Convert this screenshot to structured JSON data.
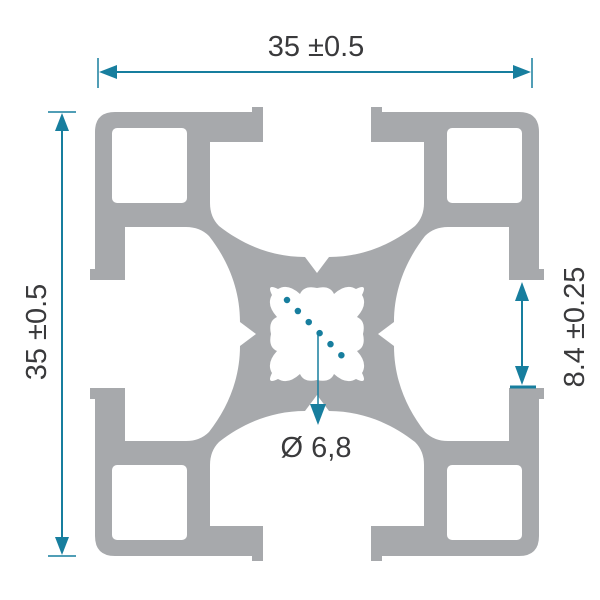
{
  "diagram": {
    "subject": "aluminum-extrusion-profile-cross-section",
    "dimensions": {
      "width": {
        "label": "35 ±0.5",
        "value": 35,
        "tolerance": 0.5
      },
      "height": {
        "label": "35 ±0.5",
        "value": 35,
        "tolerance": 0.5
      },
      "slot": {
        "label": "8.4 ±0.25",
        "value": 8.4,
        "tolerance": 0.25
      },
      "bore": {
        "label": "Ø 6,8",
        "value": 6.8
      }
    }
  },
  "colors": {
    "aluminum": "#a7a9ac",
    "accent": "#177e9e",
    "text": "#3a3a3c",
    "background": "#ffffff"
  }
}
